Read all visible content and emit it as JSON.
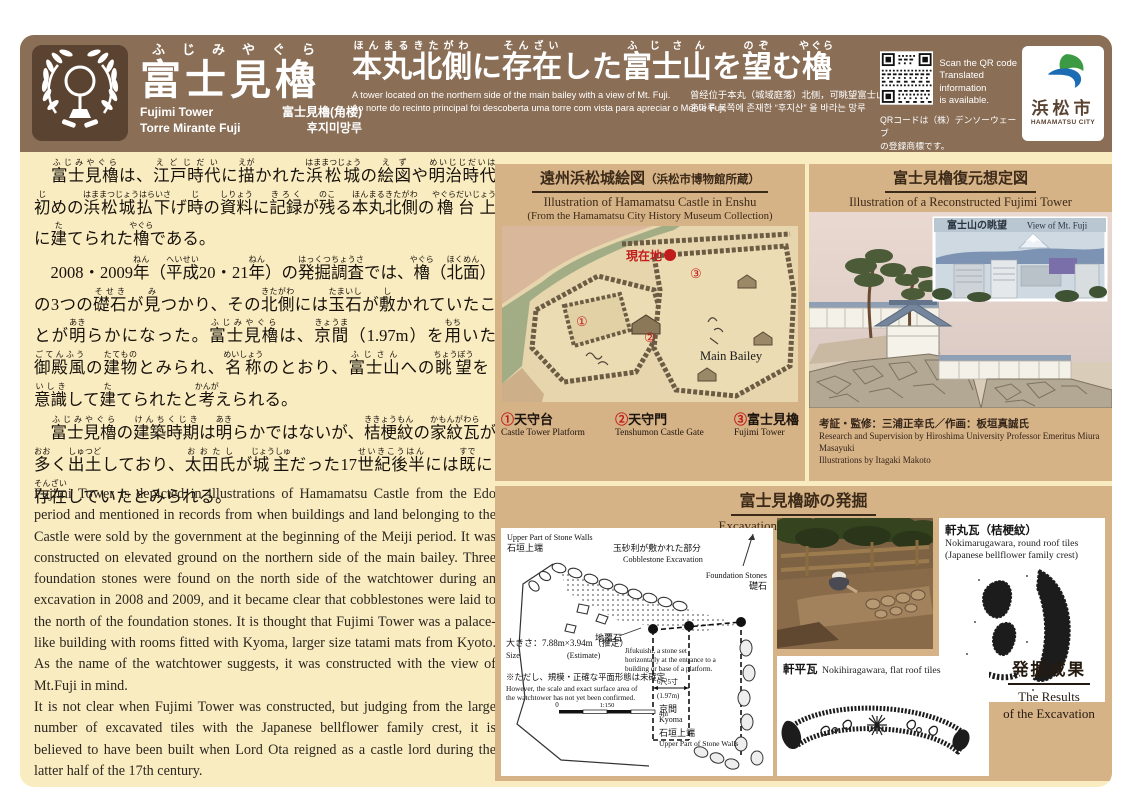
{
  "header": {
    "name": {
      "kana": "ふじみやぐら",
      "ja": "富士見櫓",
      "en": "Fujimi Tower",
      "zh": "富士見櫓(角楼)",
      "pt": "Torre Mirante Fuji",
      "ko": "후지미망루"
    },
    "title_segments": [
      {
        "t": "本丸",
        "r": "ほんまる"
      },
      {
        "t": "北側",
        "r": "きたがわ"
      },
      {
        "t": "に"
      },
      {
        "t": "存在",
        "r": "そんざい"
      },
      {
        "t": "した"
      },
      {
        "t": "富士山",
        "r": "ふじさん"
      },
      {
        "t": "を"
      },
      {
        "t": "望",
        "r": "のぞ"
      },
      {
        "t": "む"
      },
      {
        "t": "櫓",
        "r": "やぐら"
      }
    ],
    "subtitle_en": "A tower located on the northern side of the main bailey with a view of Mt. Fuji.",
    "subtitle_pt": "Ao norte do recinto principal foi descoberta uma torre com vista para apreciar o Monte Fuji.",
    "subtitle_zh": "曾经位于本丸（城域庭落）北侧，可眺望富士山的角楼",
    "subtitle_ko": "혼마루 북쪽에 존재한 “후지산” 을 바라는 망루",
    "qr": {
      "en1": "Scan the QR code",
      "en2": "Translated information",
      "en3": "is available.",
      "ja1": "QRコードは（株）デンソーウェーブ",
      "ja2": "の登録商標です。"
    },
    "city": {
      "ja": "浜松市",
      "en": "HAMAMATSU CITY"
    }
  },
  "jp_paragraphs": {
    "p1": [
      {
        "t": "　"
      },
      {
        "t": "富士見櫓",
        "r": "ふじみやぐら"
      },
      {
        "t": "は、"
      },
      {
        "t": "江戸時代",
        "r": "えどじだい"
      },
      {
        "t": "に"
      },
      {
        "t": "描",
        "r": "えが"
      },
      {
        "t": "かれた"
      },
      {
        "t": "浜松城",
        "r": "はままつじょう"
      },
      {
        "t": "の"
      },
      {
        "t": "絵図",
        "r": "えず"
      },
      {
        "t": "や"
      },
      {
        "t": "明治時代初",
        "r": "めいじじだいはじ"
      },
      {
        "t": "めの"
      },
      {
        "t": "浜松城払下",
        "r": "はままつじょうはらいさ"
      },
      {
        "t": "げ"
      },
      {
        "t": "時",
        "r": "じ"
      },
      {
        "t": "の"
      },
      {
        "t": "資料",
        "r": "しりょう"
      },
      {
        "t": "に"
      },
      {
        "t": "記録",
        "r": "きろく"
      },
      {
        "t": "が"
      },
      {
        "t": "残",
        "r": "のこ"
      },
      {
        "t": "る"
      },
      {
        "t": "本丸北側",
        "r": "ほんまるきたがわ"
      },
      {
        "t": "の"
      },
      {
        "t": "櫓台上",
        "r": "やぐらだいじょう"
      },
      {
        "t": "に"
      },
      {
        "t": "建",
        "r": "た"
      },
      {
        "t": "てられた"
      },
      {
        "t": "櫓",
        "r": "やぐら"
      },
      {
        "t": "である。"
      }
    ],
    "p2": [
      {
        "t": "　2008・2009"
      },
      {
        "t": "年",
        "r": "ねん"
      },
      {
        "t": "（"
      },
      {
        "t": "平成",
        "r": "へいせい"
      },
      {
        "t": "20・21"
      },
      {
        "t": "年",
        "r": "ねん"
      },
      {
        "t": "）の"
      },
      {
        "t": "発掘調査",
        "r": "はっくつちょうさ"
      },
      {
        "t": "では、"
      },
      {
        "t": "櫓",
        "r": "やぐら"
      },
      {
        "t": "（"
      },
      {
        "t": "北面",
        "r": "ほくめん"
      },
      {
        "t": "）の3つの"
      },
      {
        "t": "礎石",
        "r": "そせき"
      },
      {
        "t": "が"
      },
      {
        "t": "見",
        "r": "み"
      },
      {
        "t": "つかり、その"
      },
      {
        "t": "北側",
        "r": "きたがわ"
      },
      {
        "t": "には"
      },
      {
        "t": "玉石",
        "r": "たまいし"
      },
      {
        "t": "が"
      },
      {
        "t": "敷",
        "r": "し"
      },
      {
        "t": "かれていたことが"
      },
      {
        "t": "明",
        "r": "あき"
      },
      {
        "t": "らかになった。"
      },
      {
        "t": "富士見櫓",
        "r": "ふじみやぐら"
      },
      {
        "t": "は、"
      },
      {
        "t": "京間",
        "r": "きょうま"
      },
      {
        "t": "（1.97m）を"
      },
      {
        "t": "用",
        "r": "もち"
      },
      {
        "t": "いた"
      },
      {
        "t": "御殿風",
        "r": "ごてんふう"
      },
      {
        "t": "の"
      },
      {
        "t": "建物",
        "r": "たてもの"
      },
      {
        "t": "とみられ、"
      },
      {
        "t": "名称",
        "r": "めいしょう"
      },
      {
        "t": "のとおり、"
      },
      {
        "t": "富士山",
        "r": "ふじさん"
      },
      {
        "t": "への"
      },
      {
        "t": "眺望",
        "r": "ちょうぼう"
      },
      {
        "t": "を"
      },
      {
        "t": "意識",
        "r": "いしき"
      },
      {
        "t": "して"
      },
      {
        "t": "建",
        "r": "た"
      },
      {
        "t": "てられたと"
      },
      {
        "t": "考",
        "r": "かんが"
      },
      {
        "t": "えられる。"
      }
    ],
    "p3": [
      {
        "t": "　"
      },
      {
        "t": "富士見櫓",
        "r": "ふじみやぐら"
      },
      {
        "t": "の"
      },
      {
        "t": "建築時期",
        "r": "けんちくじき"
      },
      {
        "t": "は"
      },
      {
        "t": "明",
        "r": "あき"
      },
      {
        "t": "らかではないが、"
      },
      {
        "t": "桔梗紋",
        "r": "ききょうもん"
      },
      {
        "t": "の"
      },
      {
        "t": "家紋瓦",
        "r": "かもんがわら"
      },
      {
        "t": "が"
      },
      {
        "t": "多",
        "r": "おお"
      },
      {
        "t": "く"
      },
      {
        "t": "出土",
        "r": "しゅつど"
      },
      {
        "t": "しており、"
      },
      {
        "t": "太田氏",
        "r": "おおたし"
      },
      {
        "t": "が"
      },
      {
        "t": "城主",
        "r": "じょうしゅ"
      },
      {
        "t": "だった17"
      },
      {
        "t": "世紀後半",
        "r": "せいきこうはん"
      },
      {
        "t": "には"
      },
      {
        "t": "既",
        "r": "すで"
      },
      {
        "t": "に"
      },
      {
        "t": "存在",
        "r": "そんざい"
      },
      {
        "t": "していたとみられる。"
      }
    ]
  },
  "en_paragraphs": {
    "p1": "Fujimi Tower is depicted in illustrations of Hamamatsu Castle from the Edo period and mentioned in records from when buildings and land belonging to the Castle were sold by the government at the beginning of the Meiji period. It was constructed on elevated ground on the northern side of the main bailey. Three foundation stones were found on the north side of the watchtower during an excavation in 2008 and 2009, and it became clear that cobblestones were laid to the north of the foundation stones. It is thought that Fujimi Tower was a palace-like building with rooms fitted with Kyoma, larger size tatami mats from Kyoto. As the name of the watchtower suggests, it was constructed with the view of Mt.Fuji in mind.",
    "p2": "It is not clear when Fujimi Tower was constructed, but judging from the large number of excavated tiles with the Japanese bellflower family crest, it is believed to have been built when Lord Ota reigned as a castle lord during the latter half of the 17th century."
  },
  "map_panel": {
    "title": "遠州浜松城絵図",
    "title_paren": "（浜松市博物館所蔵）",
    "subtitle1": "Illustration of Hamamatsu Castle in Enshu",
    "subtitle2": "(From the Hamamatsu City History Museum Collection)",
    "markers": {
      "loc": "現在地",
      "m1": "①",
      "m2": "②",
      "m3": "③",
      "bailey": "Main Bailey"
    },
    "legend": [
      {
        "num": "①",
        "ja": "天守台",
        "en": "Castle Tower Platform"
      },
      {
        "num": "②",
        "ja": "天守門",
        "en": "Tenshumon Castle Gate"
      },
      {
        "num": "③",
        "ja": "富士見櫓",
        "en": "Fujimi Tower"
      }
    ]
  },
  "recon_panel": {
    "title": "富士見櫓復元想定図",
    "subtitle": "Illustration of a Reconstructed Fujimi Tower",
    "photo_ja": "富士山の眺望",
    "photo_en": "View of Mt. Fuji",
    "credit_ja": "考証・監修：三浦正幸氏／作画：板垣真誠氏",
    "credit_en1": "Research and Supervision by Hiroshima University Professor Emeritus Miura Masayuki",
    "credit_en2": "Illustrations by Itagaki Makoto"
  },
  "exc_panel": {
    "title": "富士見櫓跡の発掘",
    "subtitle": "Excavation Site of Fujimi Tower",
    "plan": {
      "upper_en": "Upper Part of Stone Walls",
      "upper_ja": "石垣上端",
      "cobble_ja": "玉砂利が敷かれた部分",
      "cobble_en": "Cobblestone Excavation",
      "foundation_en": "Foundation Stones",
      "foundation_ja": "礎石",
      "jifuku_ja": "地覆石",
      "jifuku_en1": "Jifukuishi, a stone set",
      "jifuku_en2": "horizontally at the entrance to a",
      "jifuku_en3": "building or base of a platform.",
      "dim_ja": "6尺5寸",
      "dim_m": "(1.97m)",
      "kyoma_ja": "京間",
      "kyoma_en": "Kyoma",
      "size_ja": "大きさ：7.88m×3.94m（推定）",
      "size_en1": "Size",
      "size_en2": "(Estimate)",
      "note_ja": "※ただし、規模・正確な平面形態は未確定",
      "note_en1": "However, the scale and exact surface area of",
      "note_en2": "the watchtower has not yet been confirmed.",
      "scale_0": "0",
      "scale_ratio": "1:150",
      "scale_4m": "4m",
      "lower_ja": "石垣上端",
      "lower_en": "Upper Part of Stone Walls"
    },
    "round_tile": {
      "ja": "軒丸瓦（桔梗紋）",
      "en1": "Nokimarugawara, round roof tiles",
      "en2": "(Japanese bellflower family crest)"
    },
    "flat_tile": {
      "ja": "軒平瓦",
      "en": "Nokihiragawara, flat roof tiles"
    },
    "results": {
      "ja": "発掘成果",
      "en1": "The Results",
      "en2": "of the Excavation"
    }
  }
}
